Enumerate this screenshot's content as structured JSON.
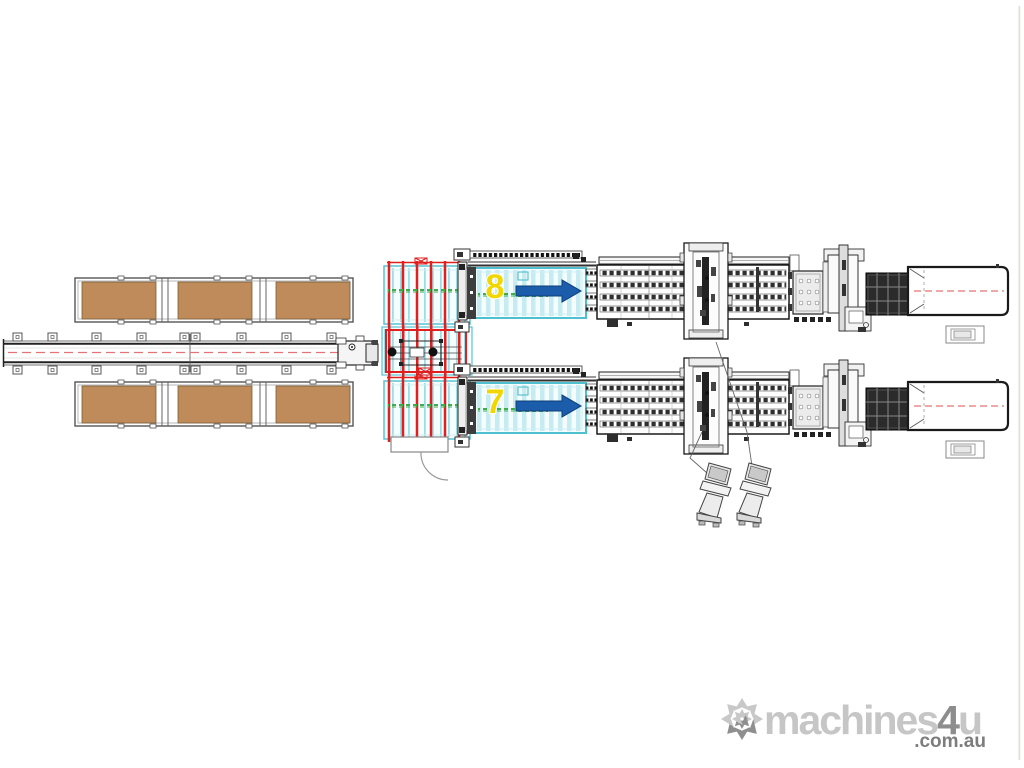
{
  "page": {
    "background": "#ffffff"
  },
  "stations": {
    "top_line_number": "8",
    "bottom_line_number": "7"
  },
  "watermark": {
    "brand_part1": "machines",
    "brand_part2": "4",
    "brand_part3": "u",
    "suffix": ".com.au"
  },
  "colors": {
    "pallet_brown": "#bf8b5a",
    "rack_red": "#e01f1f",
    "conveyor_cyan": "#4ec0d0",
    "stripe_cyan": "#c6ebf0",
    "arrow_blue": "#1b5cab",
    "centerline_red": "#e57373",
    "marker_green": "#3fae4a",
    "station_yellow": "#f2d600",
    "machine_line": "#1a1a1a",
    "logo_light_gray": "#c6c6c6",
    "logo_dark_gray": "#8d8d8d"
  },
  "components": [
    "pallet-infeed-conveyor",
    "pallet-rack-top",
    "pallet-rack-bottom",
    "transfer-carriage",
    "sorting-rack-top",
    "loading-crane",
    "sorting-rack-bottom",
    "tilting-loader-line-8",
    "tilting-loader-line-7",
    "cutting-table",
    "breakout-table",
    "outfeed-table",
    "operator-consoles",
    "swing-door"
  ]
}
